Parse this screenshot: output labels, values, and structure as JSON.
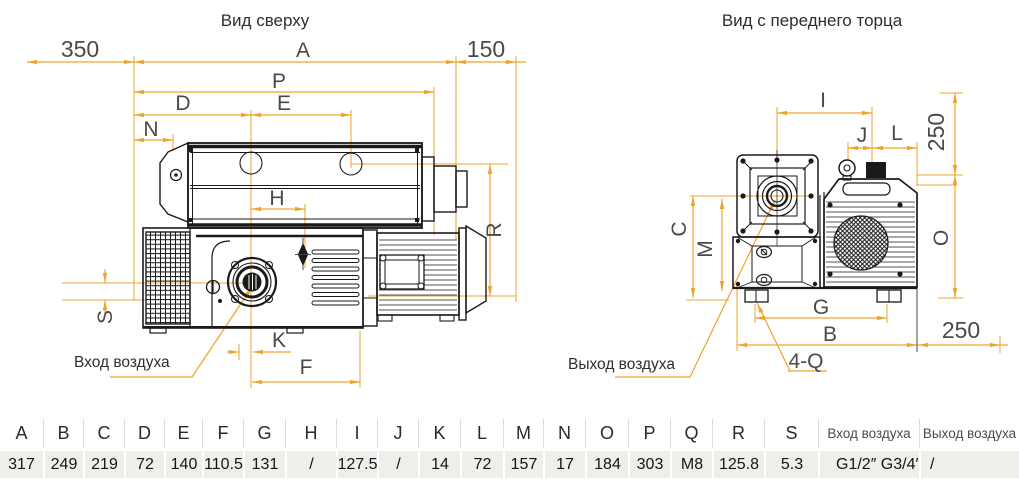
{
  "titles": {
    "top": "Вид сверху",
    "front": "Вид с переднего торца"
  },
  "top_view": {
    "dims": {
      "d350": "350",
      "a": "A",
      "d150": "150",
      "p": "P",
      "d": "D",
      "e": "E",
      "n": "N",
      "h": "H",
      "r": "R",
      "s": "S",
      "k": "K",
      "f": "F"
    },
    "inlet_label": "Вход воздуха"
  },
  "front_view": {
    "dims": {
      "i": "I",
      "j": "J",
      "l": "L",
      "v250": "250",
      "o": "O",
      "c": "C",
      "m": "M",
      "g": "G",
      "b": "B",
      "h250": "250",
      "q": "4-Q"
    },
    "outlet_label": "Выход воздуха"
  },
  "table": {
    "columns": [
      {
        "header": "A",
        "value": "317"
      },
      {
        "header": "B",
        "value": "249"
      },
      {
        "header": "C",
        "value": "219"
      },
      {
        "header": "D",
        "value": "72"
      },
      {
        "header": "E",
        "value": "140"
      },
      {
        "header": "F",
        "value": "110.5"
      },
      {
        "header": "G",
        "value": "131"
      },
      {
        "header": "H",
        "value": "/"
      },
      {
        "header": "I",
        "value": "127.5"
      },
      {
        "header": "J",
        "value": "/"
      },
      {
        "header": "K",
        "value": "14"
      },
      {
        "header": "L",
        "value": "72"
      },
      {
        "header": "M",
        "value": "157"
      },
      {
        "header": "N",
        "value": "17"
      },
      {
        "header": "O",
        "value": "184"
      },
      {
        "header": "P",
        "value": "303"
      },
      {
        "header": "Q",
        "value": "M8"
      },
      {
        "header": "R",
        "value": "125.8"
      },
      {
        "header": "S",
        "value": "5.3"
      },
      {
        "header": "Вход воздуха",
        "value": "G1/2″  G3/4″"
      },
      {
        "header": "Выход воздуха",
        "value": "/"
      }
    ]
  },
  "colors": {
    "dimension": "#efa32c",
    "line": "#1a1a1a",
    "row_bg": "#efeeeb"
  }
}
